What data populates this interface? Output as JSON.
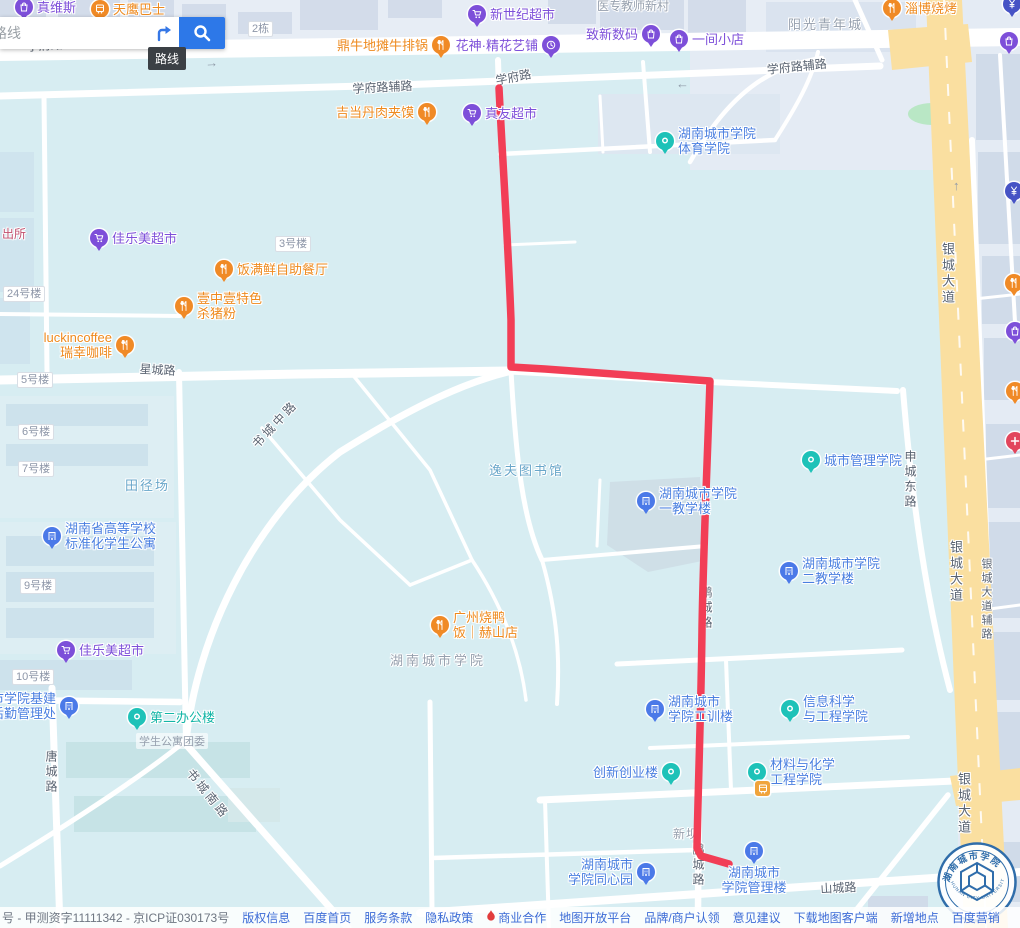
{
  "search": {
    "input_text": "路线",
    "tooltip": "路线"
  },
  "palette": {
    "purple": "#7d4fd9",
    "orange": "#f08a26",
    "blue": "#4b79e8",
    "teal": "#1ec2b8",
    "bank": "#4653c5",
    "red": "#e2455c",
    "busstop": "#f0a43c",
    "purpleText": "#7d4fd9",
    "orangeText": "#ee8a1e",
    "blueText": "#4a7fe0",
    "tealText": "#12b5a6",
    "route": "#f23e56"
  },
  "route": {
    "d": "M499,88 C502,150 508,240 511,320 L511,367 L545,369 L710,381 C707,470 703,560 702,630 C701,710 698,790 697,848 L701,856 L729,864",
    "width": 7.5
  },
  "map": {
    "road_labels": [
      {
        "t": "学府路",
        "x": 26,
        "y": 38,
        "rot": -4
      },
      {
        "t": "学府路辅路",
        "x": 352,
        "y": 80,
        "rot": -3
      },
      {
        "t": "学府路",
        "x": 494,
        "y": 72,
        "rot": -11
      },
      {
        "t": "学府路辅路",
        "x": 766,
        "y": 61,
        "rot": -6
      },
      {
        "t": "星城路",
        "x": 140,
        "y": 360,
        "rot": 3
      },
      {
        "t": "书城中路",
        "x": 248,
        "y": 440,
        "rot": -47,
        "ls": 3
      },
      {
        "t": "书城南路",
        "x": 196,
        "y": 765,
        "rot": 51,
        "ls": 3
      },
      {
        "t": "唐城路",
        "x": 43,
        "y": 750,
        "v": 1
      },
      {
        "t": "申城东路",
        "x": 902,
        "y": 450,
        "v": 1
      },
      {
        "t": "银城大道",
        "x": 938,
        "y": 242,
        "v": 1,
        "size": 13
      },
      {
        "t": "银城大道",
        "x": 946,
        "y": 540,
        "v": 1,
        "size": 13
      },
      {
        "t": "银城大道",
        "x": 954,
        "y": 772,
        "v": 1,
        "size": 13
      },
      {
        "t": "银城大道辅路",
        "x": 978,
        "y": 558,
        "v": 1,
        "size": 11
      },
      {
        "t": "鹏城路",
        "x": 698,
        "y": 586,
        "v": 1
      },
      {
        "t": "鹏城路",
        "x": 690,
        "y": 843,
        "v": 1
      },
      {
        "t": "山城路",
        "x": 820,
        "y": 880,
        "rot": -3
      }
    ],
    "area_labels": [
      {
        "t": "医专教师新村",
        "x": 597,
        "y": -3,
        "c": "gray",
        "size": 12
      },
      {
        "t": "阳光青年城",
        "x": 788,
        "y": 14,
        "c": "gray",
        "size": 13,
        "ls": 2
      },
      {
        "t": "田径场",
        "x": 125,
        "y": 475,
        "c": "blue",
        "size": 13,
        "ls": 2
      },
      {
        "t": "逸夫图书馆",
        "x": 489,
        "y": 460,
        "c": "blue",
        "size": 13,
        "ls": 2
      },
      {
        "t": "湖南城市学院",
        "x": 390,
        "y": 650,
        "c": "gray",
        "size": 13,
        "ls": 3
      },
      {
        "t": "新坝",
        "x": 673,
        "y": 825,
        "c": "gray",
        "size": 12,
        "ls": 1
      },
      {
        "t": "学生公寓团委",
        "x": 136,
        "y": 733,
        "c": "gray",
        "size": 11,
        "bg": 1
      },
      {
        "t": "出所",
        "x": 2,
        "y": 225,
        "c": "rose",
        "size": 12
      }
    ],
    "arrows": [
      {
        "t": "→",
        "x": 205,
        "y": 55,
        "rot": -3
      },
      {
        "t": "←",
        "x": 676,
        "y": 76
      },
      {
        "t": "↑",
        "x": 953,
        "y": 178
      }
    ],
    "badges": [
      {
        "t": "2栋",
        "x": 248,
        "y": 21
      },
      {
        "t": "3号楼",
        "x": 275,
        "y": 236
      },
      {
        "t": "24号楼",
        "x": 3,
        "y": 286
      },
      {
        "t": "5号楼",
        "x": 17,
        "y": 372
      },
      {
        "t": "6号楼",
        "x": 18,
        "y": 424
      },
      {
        "t": "7号楼",
        "x": 18,
        "y": 461
      },
      {
        "t": "9号楼",
        "x": 20,
        "y": 578
      },
      {
        "t": "10号楼",
        "x": 12,
        "y": 669
      }
    ],
    "pois": [
      {
        "x": 24,
        "y": 7,
        "pin": "purple",
        "icon": "bag",
        "side": "right",
        "lines": [
          "真维斯"
        ]
      },
      {
        "x": 100,
        "y": 9,
        "pin": "orange",
        "icon": "bus",
        "side": "right",
        "lines": [
          "天鹰巴士"
        ],
        "tc": "orangeText"
      },
      {
        "x": 477,
        "y": 14,
        "pin": "purple",
        "icon": "cart",
        "side": "right",
        "lines": [
          "新世纪超市"
        ]
      },
      {
        "x": 441,
        "y": 45,
        "pin": "orange",
        "icon": "food",
        "side": "left",
        "lines": [
          "鼎牛地摊牛排锅"
        ]
      },
      {
        "x": 551,
        "y": 45,
        "pin": "purple",
        "icon": "clock",
        "side": "left",
        "lines": [
          "花神·精花艺铺"
        ]
      },
      {
        "x": 651,
        "y": 34,
        "pin": "purple",
        "icon": "bag",
        "side": "left",
        "lines": [
          "致新数码"
        ]
      },
      {
        "x": 679,
        "y": 39,
        "pin": "purple",
        "icon": "bag",
        "side": "right",
        "lines": [
          "一间小店"
        ]
      },
      {
        "x": 892,
        "y": 8,
        "pin": "orange",
        "icon": "food",
        "side": "right",
        "lines": [
          "淄博烧烤"
        ]
      },
      {
        "x": 427,
        "y": 112,
        "pin": "orange",
        "icon": "food",
        "side": "left",
        "lines": [
          "吉当丹肉夹馍"
        ]
      },
      {
        "x": 472,
        "y": 113,
        "pin": "purple",
        "icon": "cart",
        "side": "right",
        "lines": [
          "真友超市"
        ]
      },
      {
        "x": 665,
        "y": 141,
        "pin": "teal",
        "icon": "ring",
        "side": "right",
        "lines": [
          "湖南城市学院",
          "体育学院"
        ],
        "tc": "blueText"
      },
      {
        "x": 99,
        "y": 238,
        "pin": "purple",
        "icon": "cart",
        "side": "right",
        "lines": [
          "佳乐美超市"
        ]
      },
      {
        "x": 224,
        "y": 269,
        "pin": "orange",
        "icon": "food",
        "side": "right",
        "lines": [
          "饭满鲜自助餐厅"
        ]
      },
      {
        "x": 184,
        "y": 306,
        "pin": "orange",
        "icon": "food",
        "side": "right",
        "lines": [
          "壹中壹特色",
          "杀猪粉"
        ]
      },
      {
        "x": 125,
        "y": 345,
        "pin": "orange",
        "icon": "food",
        "side": "left",
        "lines": [
          "luckincoffee",
          "瑞幸咖啡"
        ]
      },
      {
        "x": 52,
        "y": 536,
        "pin": "blue",
        "icon": "building",
        "side": "right",
        "lines": [
          "湖南省高等学校",
          "标准化学生公寓"
        ],
        "tc": "blueText"
      },
      {
        "x": 646,
        "y": 501,
        "pin": "blue",
        "icon": "building",
        "side": "right",
        "lines": [
          "湖南城市学院",
          "一教学楼"
        ],
        "tc": "blueText"
      },
      {
        "x": 811,
        "y": 460,
        "pin": "teal",
        "icon": "ring",
        "side": "right",
        "lines": [
          "城市管理学院"
        ],
        "tc": "blueText"
      },
      {
        "x": 789,
        "y": 571,
        "pin": "blue",
        "icon": "building",
        "side": "right",
        "lines": [
          "湖南城市学院",
          "二教学楼"
        ],
        "tc": "blueText"
      },
      {
        "x": 440,
        "y": 625,
        "pin": "orange",
        "icon": "food",
        "side": "right",
        "lines": [
          "广州烧鸭",
          "饭｜赫山店"
        ]
      },
      {
        "x": 66,
        "y": 650,
        "pin": "purple",
        "icon": "cart",
        "side": "right",
        "lines": [
          "佳乐美超市"
        ]
      },
      {
        "x": 69,
        "y": 706,
        "pin": "blue",
        "icon": "building",
        "side": "left",
        "lines": [
          "城市学院基建",
          "与后勤管理处"
        ],
        "tc": "blueText"
      },
      {
        "x": 137,
        "y": 717,
        "pin": "teal",
        "icon": "ring",
        "side": "right",
        "lines": [
          "第二办公楼"
        ],
        "tc": "tealText"
      },
      {
        "x": 655,
        "y": 709,
        "pin": "blue",
        "icon": "building",
        "side": "right",
        "lines": [
          "湖南城市",
          "学院工训楼"
        ],
        "tc": "blueText"
      },
      {
        "x": 790,
        "y": 709,
        "pin": "teal",
        "icon": "ring",
        "side": "right",
        "lines": [
          "信息科学",
          "与工程学院"
        ],
        "tc": "blueText"
      },
      {
        "x": 671,
        "y": 772,
        "pin": "teal",
        "icon": "ring",
        "side": "left",
        "lines": [
          "创新创业楼"
        ],
        "tc": "blueText"
      },
      {
        "x": 757,
        "y": 772,
        "pin": "teal",
        "icon": "ring",
        "side": "right",
        "lines": [
          "材料与化学",
          "工程学院"
        ],
        "tc": "blueText"
      },
      {
        "x": 762,
        "y": 788,
        "pin": "busstop",
        "icon": "bus",
        "side": "right",
        "lines": []
      },
      {
        "x": 754,
        "y": 851,
        "pin": "blue",
        "icon": "building",
        "side": "below",
        "lines": [
          "湖南城市",
          "学院管理楼"
        ],
        "tc": "blueText"
      },
      {
        "x": 646,
        "y": 872,
        "pin": "blue",
        "icon": "building",
        "side": "left",
        "lines": [
          "湖南城市",
          "学院同心园"
        ],
        "tc": "blueText"
      }
    ],
    "edge_pois": [
      {
        "x": 1012,
        "y": 4,
        "pin": "bank",
        "icon": "yen"
      },
      {
        "x": 1009,
        "y": 41,
        "pin": "purple",
        "icon": "bag"
      },
      {
        "x": 1014,
        "y": 191,
        "pin": "bank",
        "icon": "yen"
      },
      {
        "x": 1014,
        "y": 283,
        "pin": "orange",
        "icon": "food"
      },
      {
        "x": 1015,
        "y": 331,
        "pin": "purple",
        "icon": "bag"
      },
      {
        "x": 1015,
        "y": 391,
        "pin": "orange",
        "icon": "food"
      },
      {
        "x": 1015,
        "y": 441,
        "pin": "red",
        "icon": "cross"
      }
    ]
  },
  "footer": {
    "icp": "号 - 甲测资字11111342 - 京ICP证030173号",
    "links": [
      {
        "t": "版权信息"
      },
      {
        "t": "百度首页"
      },
      {
        "t": "服务条款"
      },
      {
        "t": "隐私政策"
      },
      {
        "t": "商业合作",
        "flame": true
      },
      {
        "t": "地图开放平台"
      },
      {
        "t": "品牌/商户认领"
      },
      {
        "t": "意见建议"
      },
      {
        "t": "下载地图客户端"
      },
      {
        "t": "新增地点"
      },
      {
        "t": "百度营销"
      }
    ]
  },
  "logo": {
    "cn": "湖南城市学院",
    "en": "HUNAN CITY UNIVERSITY"
  }
}
